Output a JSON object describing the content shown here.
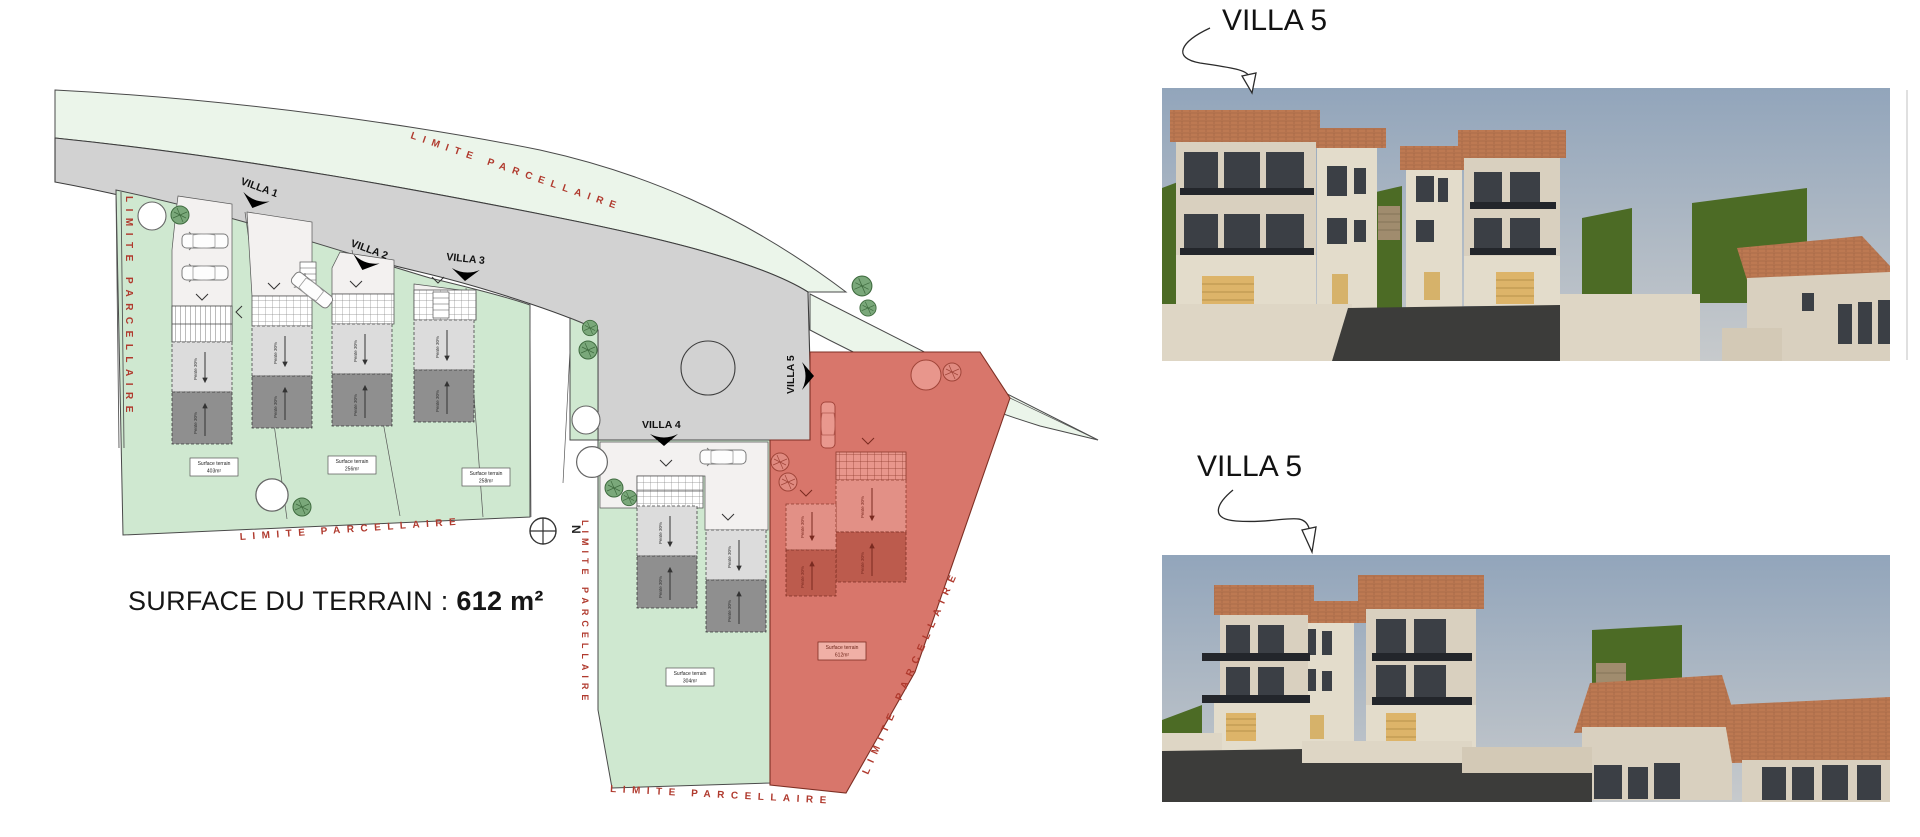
{
  "site_plan": {
    "surface_label": "SURFACE DU TERRAIN :",
    "surface_value": "612 m²",
    "boundary_label": "LIMITE PARCELLAIRE",
    "north_label": "N",
    "slope_label": "Pente 30%",
    "villas": [
      {
        "label": "VILLA 1",
        "surface_line1": "Surface terrain",
        "surface_line2": "403m²"
      },
      {
        "label": "VILLA 2",
        "surface_line1": "Surface terrain",
        "surface_line2": "256m²"
      },
      {
        "label": "VILLA 3",
        "surface_line1": "Surface terrain",
        "surface_line2": "258m²"
      },
      {
        "label": "VILLA 4",
        "surface_line1": "Surface terrain",
        "surface_line2": "304m²"
      },
      {
        "label": "VILLA 5",
        "surface_line1": "Surface terrain",
        "surface_line2": "612m²"
      }
    ],
    "colors": {
      "parcel_green": "#cfe8d0",
      "pale_green": "#ebf5ea",
      "road_gray": "#d2d2d2",
      "parcel_red": "#d8766b",
      "boundary_text": "#b03a2e"
    }
  },
  "renders": [
    {
      "label": "VILLA 5"
    },
    {
      "label": "VILLA 5"
    }
  ]
}
